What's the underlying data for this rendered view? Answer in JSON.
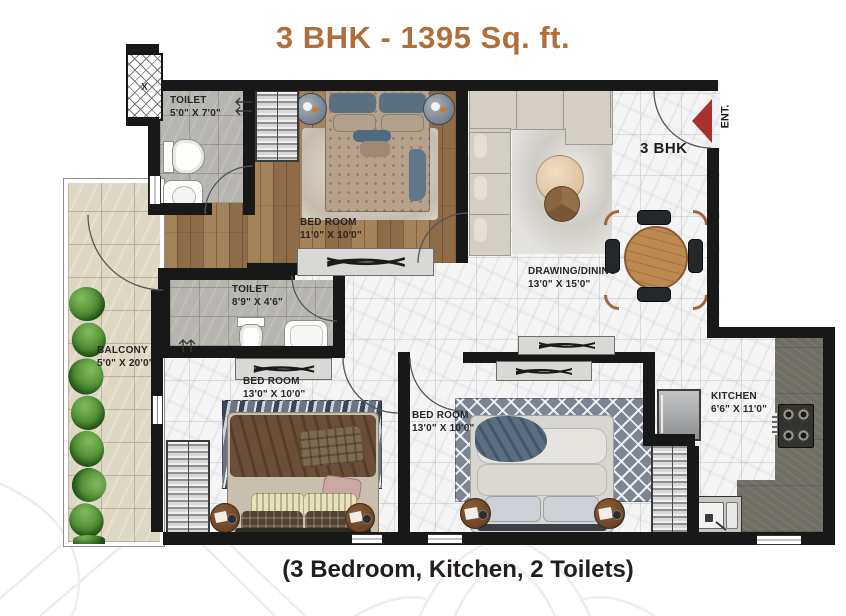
{
  "title": "3 BHK - 1395 Sq. ft.",
  "footer": "(3 Bedroom, Kitchen, 2 Toilets)",
  "unit_label": "3 BHK",
  "entrance_label": "ENT.",
  "elevator_label": "X",
  "rooms": {
    "toilet1": {
      "name": "TOILET",
      "dims": "5'0\" X 7'0\""
    },
    "bedroom1": {
      "name": "BED ROOM",
      "dims": "11'0\" X 10'0\""
    },
    "drawing_dining": {
      "name": "DRAWING/DINING",
      "dims": "13'0\" X 15'0\""
    },
    "toilet2": {
      "name": "TOILET",
      "dims": "8'9\" X 4'6\""
    },
    "balcony": {
      "name": "BALCONY",
      "dims": "5'0\" X 20'0\""
    },
    "bedroom2": {
      "name": "BED ROOM",
      "dims": "13'0\" X 10'0\""
    },
    "bedroom3": {
      "name": "BED ROOM",
      "dims": "13'0\" X 10'0\""
    },
    "kitchen": {
      "name": "KITCHEN",
      "dims": "6'6\" X 11'0\""
    }
  },
  "colors": {
    "accent": "#b06f3a",
    "footer_text": "#221e1f",
    "wall": "#181818",
    "entry_arrow": "#a93230",
    "wood_floor": "#9a7850",
    "marble_floor": "#f5f5f6",
    "toilet_floor": "#b7b5b0",
    "balcony_floor": "#ded7c4",
    "counter": "#6f6d64",
    "plant_green": "#4c8a33"
  }
}
